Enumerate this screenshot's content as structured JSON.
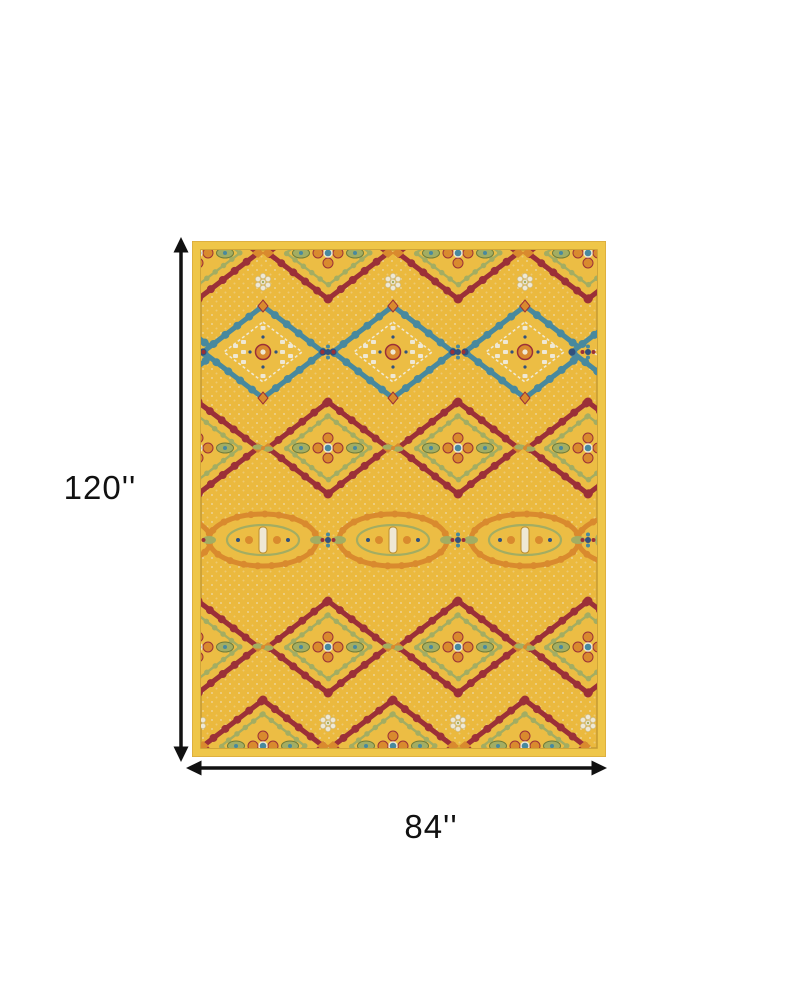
{
  "page": {
    "background": "#ffffff"
  },
  "diagram": {
    "type": "product-dimension-diagram",
    "height_dimension": {
      "label": "120''"
    },
    "width_dimension": {
      "label": "84''"
    },
    "arrow_color": "#111111",
    "label_color": "#111111",
    "rug": {
      "description": "Ornate yellow gold traditional medallion area rug with teal, red, orange, sage and navy pattern",
      "palette": {
        "band_gold": "#EFC649",
        "field_gold": "#EBB93E",
        "medallion_gold": "#ECBD44",
        "teal": "#48899E",
        "maroon": "#9B3038",
        "orange": "#D98A2E",
        "sage": "#A3AD62",
        "navy": "#31517E",
        "cream": "#EFE8D4",
        "outline": "#C59A33"
      }
    }
  }
}
